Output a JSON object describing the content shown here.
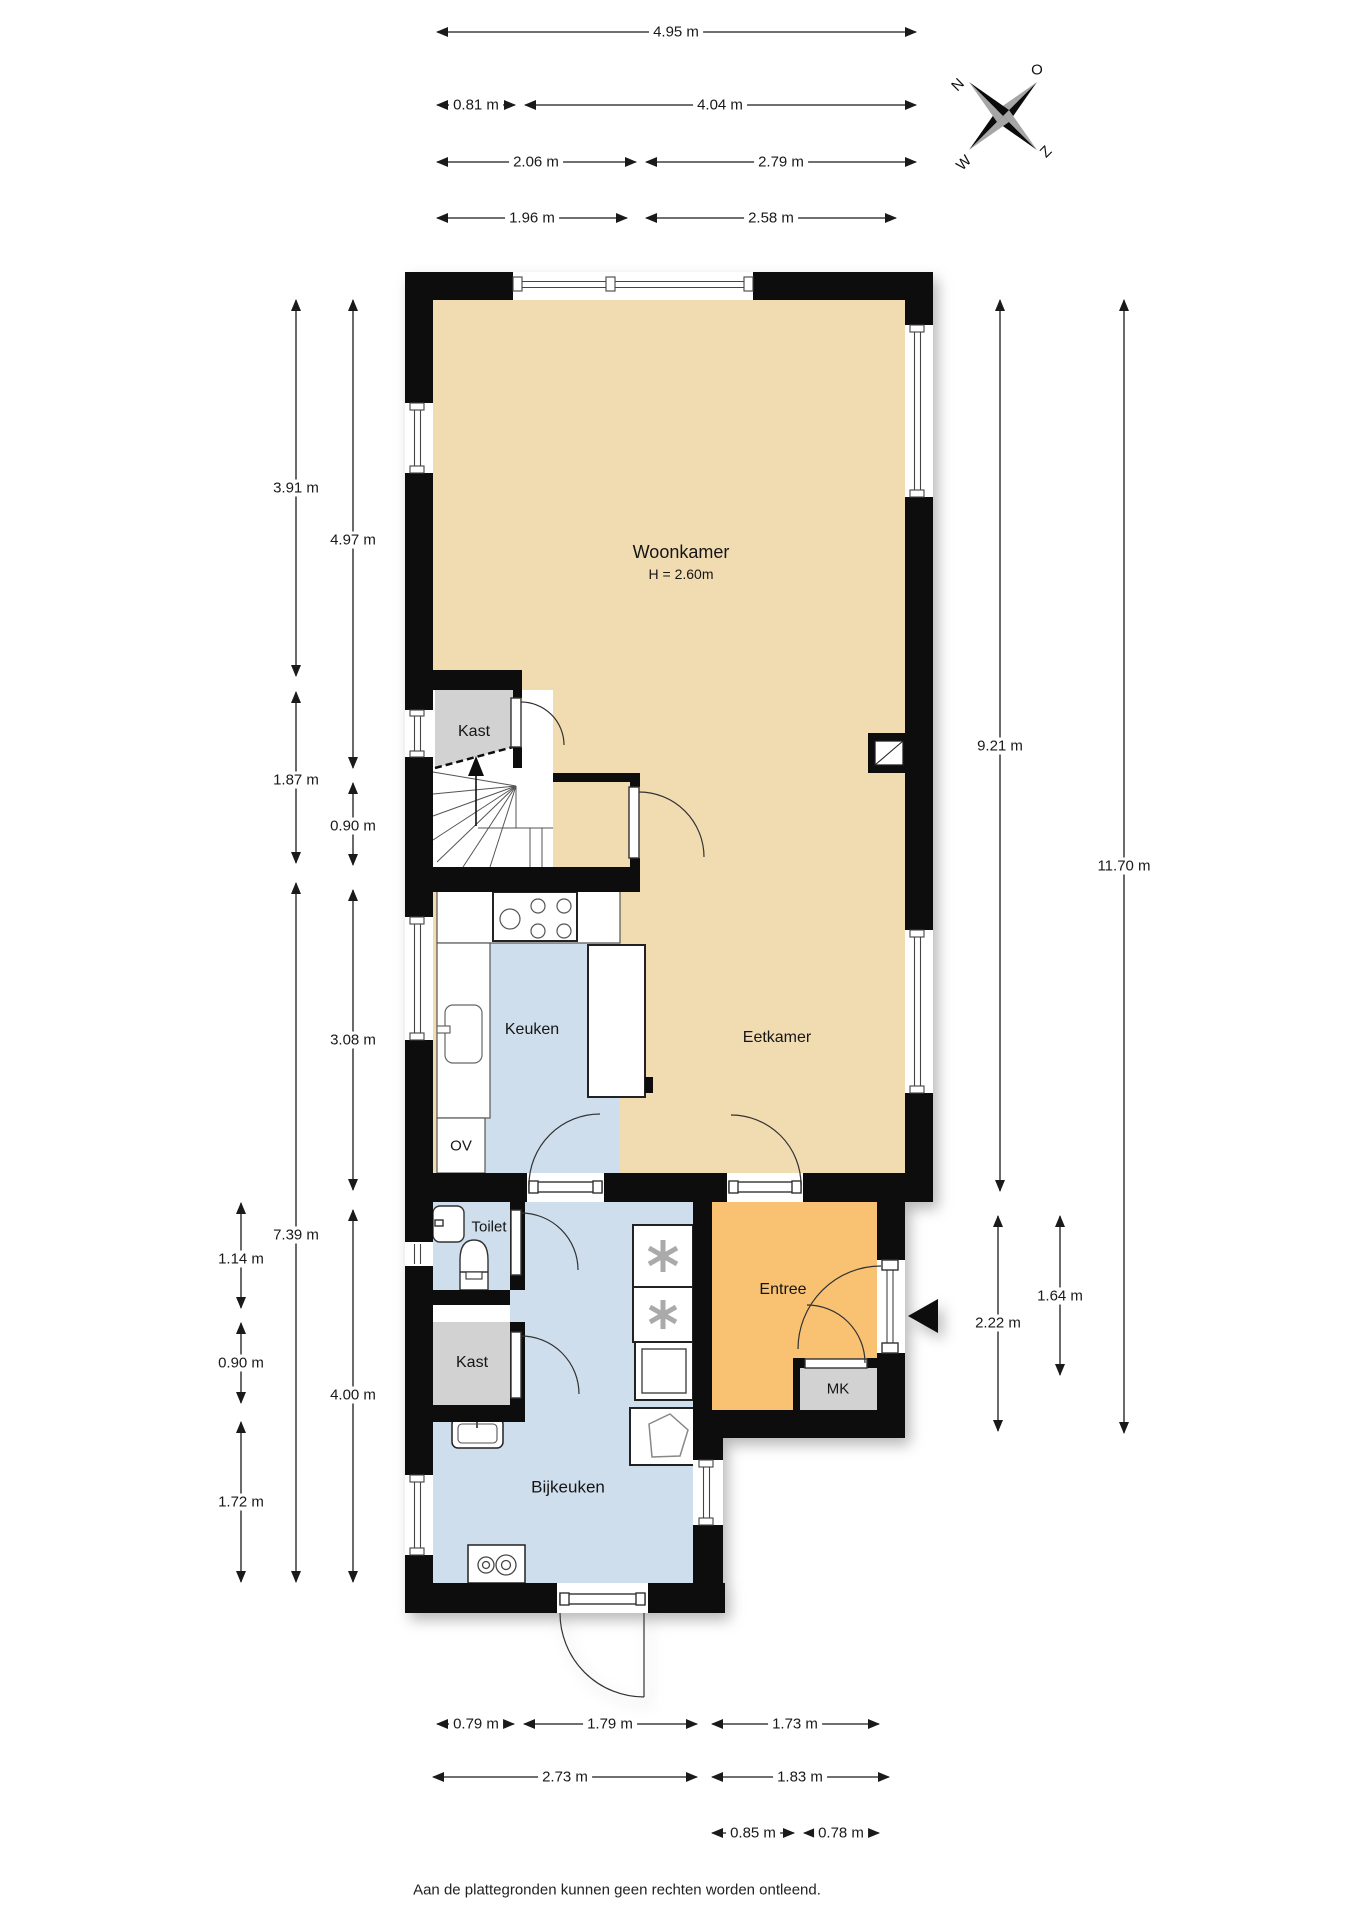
{
  "rooms": {
    "woonkamer": {
      "label": "Woonkamer",
      "ceiling_height": "H = 2.60m"
    },
    "kast_boven": {
      "label": "Kast"
    },
    "keuken": {
      "label": "Keuken"
    },
    "ov": {
      "label": "OV"
    },
    "eetkamer": {
      "label": "Eetkamer"
    },
    "toilet": {
      "label": "Toilet"
    },
    "kast_beneden": {
      "label": "Kast"
    },
    "entree": {
      "label": "Entree"
    },
    "mk": {
      "label": "MK"
    },
    "bijkeuken": {
      "label": "Bijkeuken"
    }
  },
  "dimensions": {
    "top": [
      {
        "label": "4.95 m"
      },
      {
        "label": "0.81 m"
      },
      {
        "label": "4.04 m"
      },
      {
        "label": "2.06 m"
      },
      {
        "label": "2.79 m"
      },
      {
        "label": "1.96 m"
      },
      {
        "label": "2.58 m"
      }
    ],
    "left": [
      {
        "label": "3.91 m"
      },
      {
        "label": "4.97 m"
      },
      {
        "label": "1.87 m"
      },
      {
        "label": "0.90 m"
      },
      {
        "label": "3.08 m"
      },
      {
        "label": "7.39 m"
      },
      {
        "label": "1.14 m"
      },
      {
        "label": "0.90 m"
      },
      {
        "label": "4.00 m"
      },
      {
        "label": "1.72 m"
      }
    ],
    "right": [
      {
        "label": "9.21 m"
      },
      {
        "label": "11.70 m"
      },
      {
        "label": "1.64 m"
      },
      {
        "label": "2.22 m"
      }
    ],
    "bottom": [
      {
        "label": "0.79 m"
      },
      {
        "label": "1.79 m"
      },
      {
        "label": "1.73 m"
      },
      {
        "label": "2.73 m"
      },
      {
        "label": "1.83 m"
      },
      {
        "label": "0.85 m"
      },
      {
        "label": "0.78 m"
      }
    ]
  },
  "compass": {
    "north": "N",
    "east": "O",
    "south": "Z",
    "west": "W"
  },
  "footer": {
    "disclaimer": "Aan de plattegronden kunnen geen rechten worden ontleend."
  },
  "colors": {
    "floor_living": "#f1dcb2",
    "floor_kitchen": "#cfdeec",
    "floor_entree": "#f8c272",
    "floor_closet": "#d2d2d2",
    "wall": "#0b0b0b"
  }
}
